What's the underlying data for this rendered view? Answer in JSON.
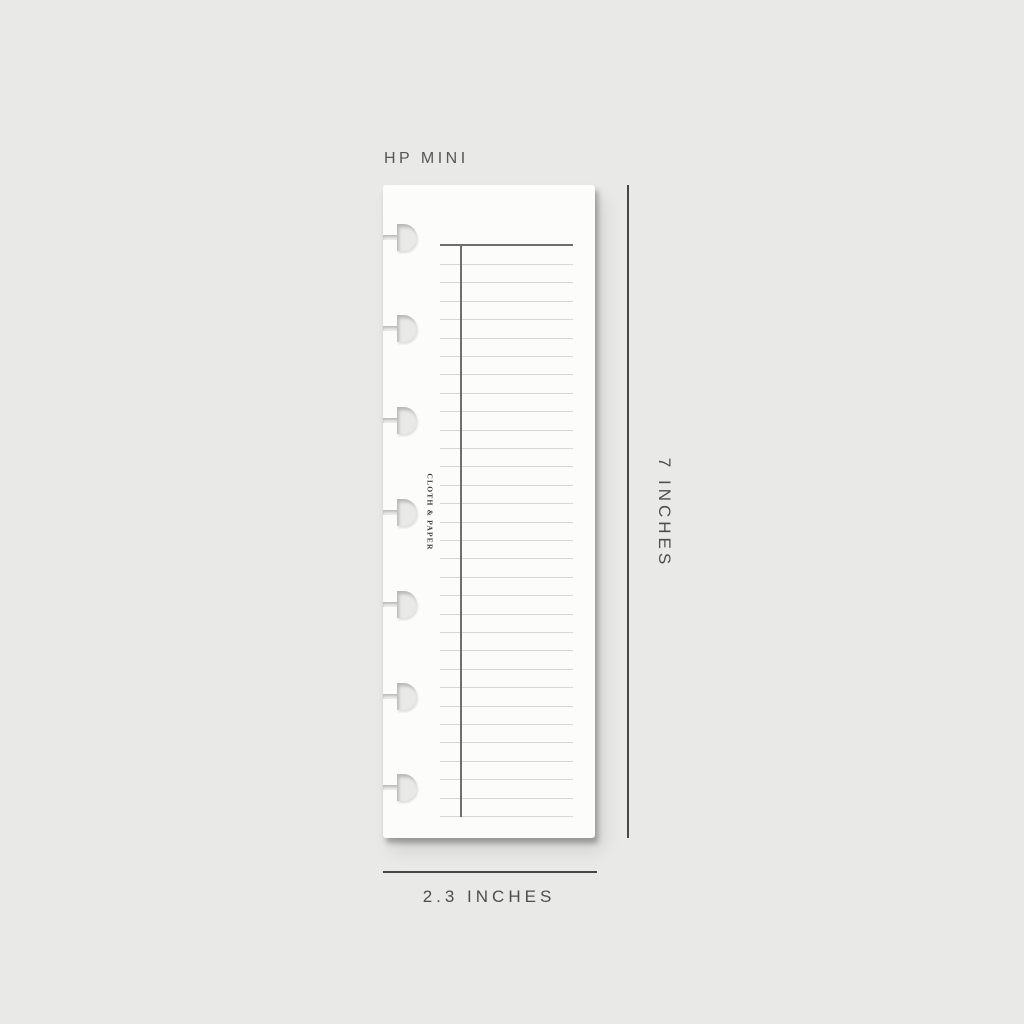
{
  "colors": {
    "background": "#e9e9e7",
    "paper": "#fcfcfb",
    "rule_line": "#d6d6d4",
    "dark_rule": "#6e6e6e",
    "dimension_line": "#474747",
    "label_text": "#4d4d4d"
  },
  "title": {
    "label": "HP MINI"
  },
  "page": {
    "brand": "CLOTH & PAPER",
    "hole_count": 7,
    "ruled_line_count": 31
  },
  "dimensions": {
    "height_label": "7 INCHES",
    "width_label": "2.3 INCHES"
  }
}
